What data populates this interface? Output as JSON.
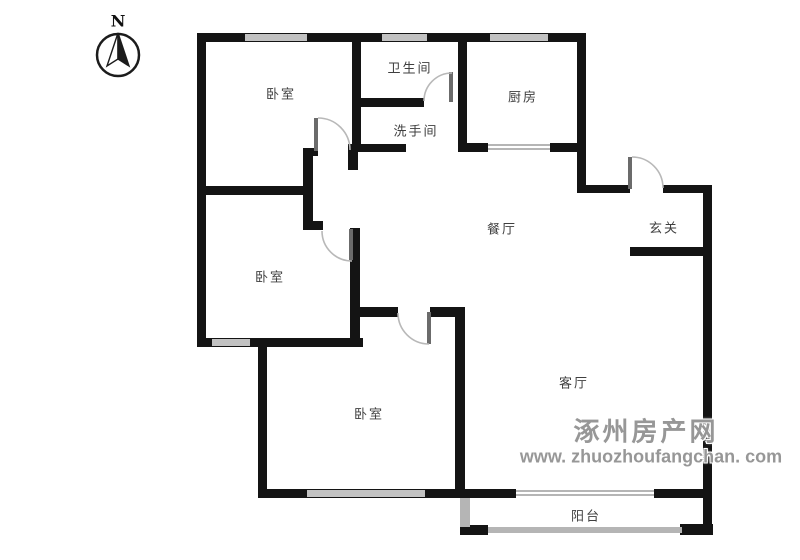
{
  "compass": {
    "label": "N"
  },
  "watermark": {
    "line1": "涿州房产网",
    "line2": "www. zhuozhoufangchan. com"
  },
  "rooms": [
    {
      "id": "bedroom-top",
      "label": "卧室"
    },
    {
      "id": "toilet",
      "label": "卫生间"
    },
    {
      "id": "washroom",
      "label": "洗手间"
    },
    {
      "id": "kitchen",
      "label": "厨房"
    },
    {
      "id": "dining",
      "label": "餐厅"
    },
    {
      "id": "entry",
      "label": "玄关"
    },
    {
      "id": "bedroom-middle",
      "label": "卧室"
    },
    {
      "id": "bedroom-bottom",
      "label": "卧室"
    },
    {
      "id": "living",
      "label": "客厅"
    },
    {
      "id": "balcony",
      "label": "阳台"
    }
  ],
  "colors": {
    "wall": "#141414",
    "window": "#c2c2c2",
    "door_arc": "#b8b8b8",
    "label": "#3f3f3f",
    "watermark": "#979797"
  }
}
